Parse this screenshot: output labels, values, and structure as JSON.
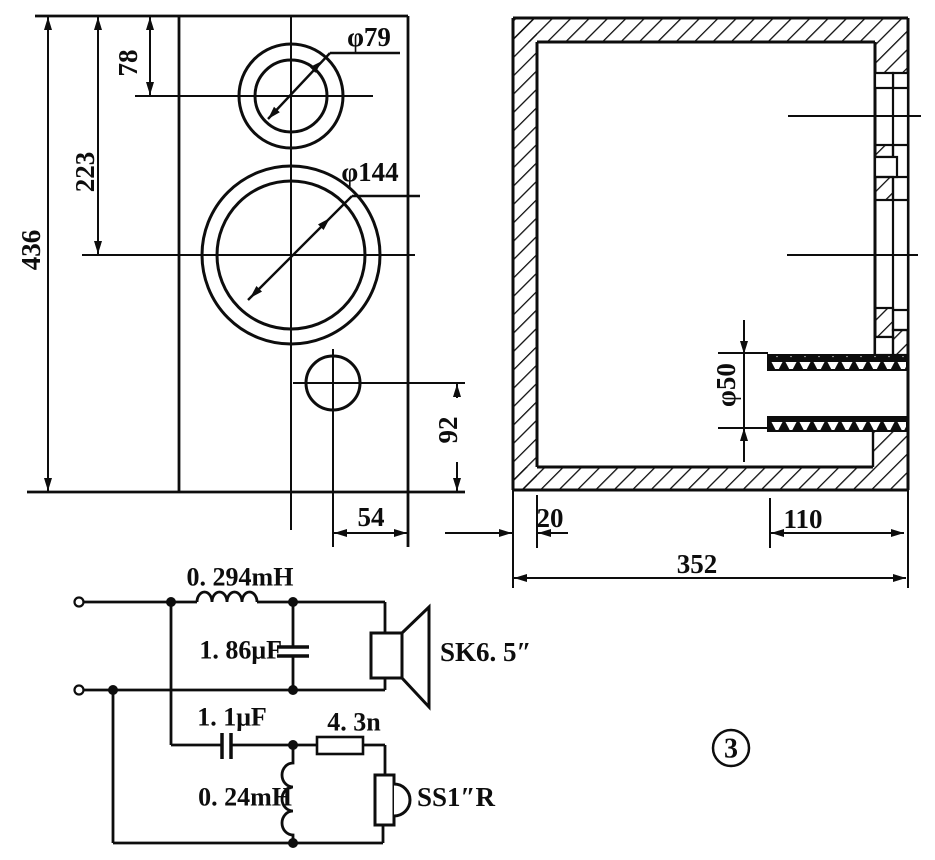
{
  "figure_label": "3",
  "front_view": {
    "dim_overall_height": "436",
    "dim_woofer_center_from_top": "223",
    "dim_tweeter_center_from_top": "78",
    "dim_port_center_from_bottom": "92",
    "dim_port_offset_from_edge": "54",
    "tweeter_cutout_diameter": "φ79",
    "woofer_cutout_diameter": "φ144"
  },
  "side_view": {
    "dim_wall_thickness": "20",
    "dim_port_tube_length": "110",
    "dim_overall_depth": "352",
    "port_tube_diameter": "φ50"
  },
  "crossover": {
    "woofer_inductor": "0. 294mH",
    "woofer_capacitor": "1. 86μF",
    "tweeter_capacitor": "1. 1μF",
    "tweeter_resistor": "4. 3n",
    "tweeter_inductor": "0. 24mH",
    "woofer_label": "SK6. 5″",
    "tweeter_label": "SS1″R"
  }
}
